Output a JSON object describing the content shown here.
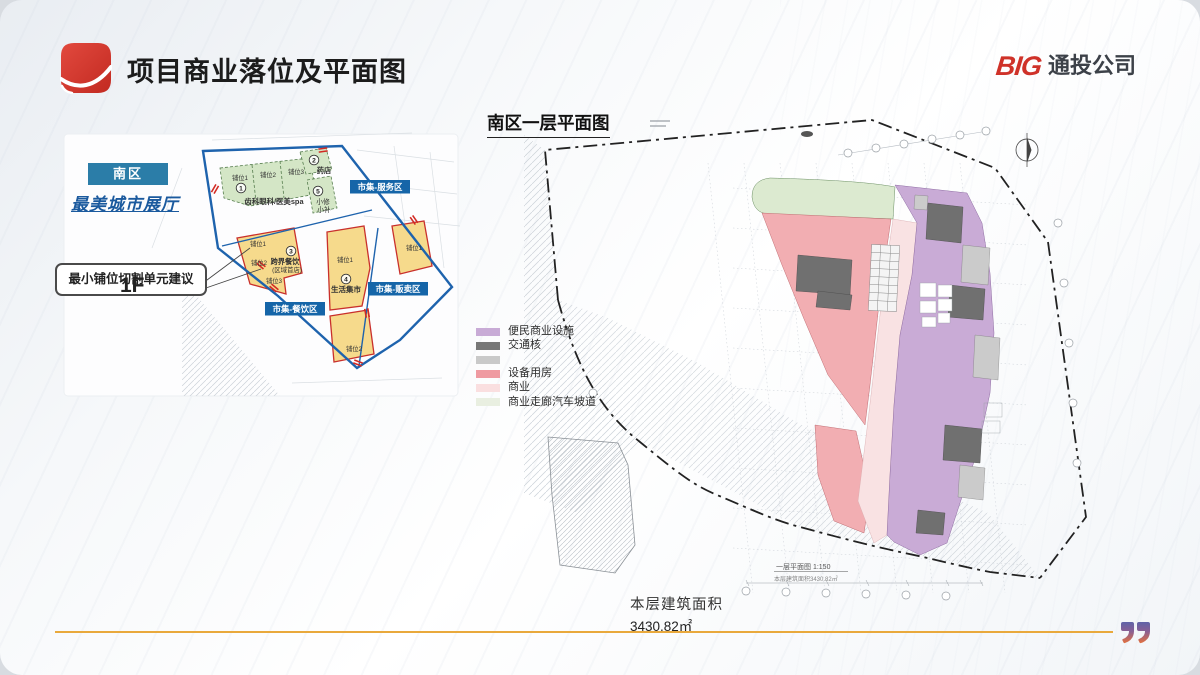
{
  "header": {
    "title": "项目商业落位及平面图",
    "logo_big": "BIG",
    "logo_company": "通投公司"
  },
  "left_map": {
    "district_badge": "南区",
    "hall_title": "最美城市展厅",
    "callout": "最小铺位切割单元建议",
    "floor_label": "1F",
    "zone_labels": {
      "service": "市集-服务区",
      "sale": "市集-贩卖区",
      "food": "市集-餐饮区"
    },
    "shops": {
      "s1_num": "1",
      "s1_name": "齿科眼科/医美spa",
      "s1_u1": "铺位1",
      "s1_u2": "铺位2",
      "s1_u3": "铺位3",
      "s2_num": "2",
      "s2_name": "药店",
      "s5_num": "5",
      "s5_line1": "小修",
      "s5_line2": "小补",
      "s3_num": "3",
      "s3_name": "跨界餐饮",
      "s3_sub": "(区域首店)",
      "s3_u1": "铺位1",
      "s3_u2": "铺位2",
      "s3_u3": "铺位3",
      "s4_num": "4",
      "s4_name": "生活集市",
      "s4_u1": "铺位1",
      "s4_u2": "铺位2"
    }
  },
  "plan": {
    "title": "南区一层平面图",
    "legend": [
      {
        "color": "#c8abd6",
        "label": "便民商业设施"
      },
      {
        "color": "#777777",
        "label": "交通核"
      },
      {
        "color": "#c9c9c9",
        "label": ""
      },
      {
        "color": "#ef9aa1",
        "label": "设备用房"
      },
      {
        "color": "#fadfe0",
        "label": "商业"
      },
      {
        "color": "#e9efe1",
        "label": "商业走廊汽车坡道"
      }
    ],
    "drawing_scale_caption": "一层平面图 1:150",
    "drawing_area_caption": "本层建筑面积3430.82㎡",
    "area_label": "本层建筑面积",
    "area_value": "3430.82㎡"
  }
}
